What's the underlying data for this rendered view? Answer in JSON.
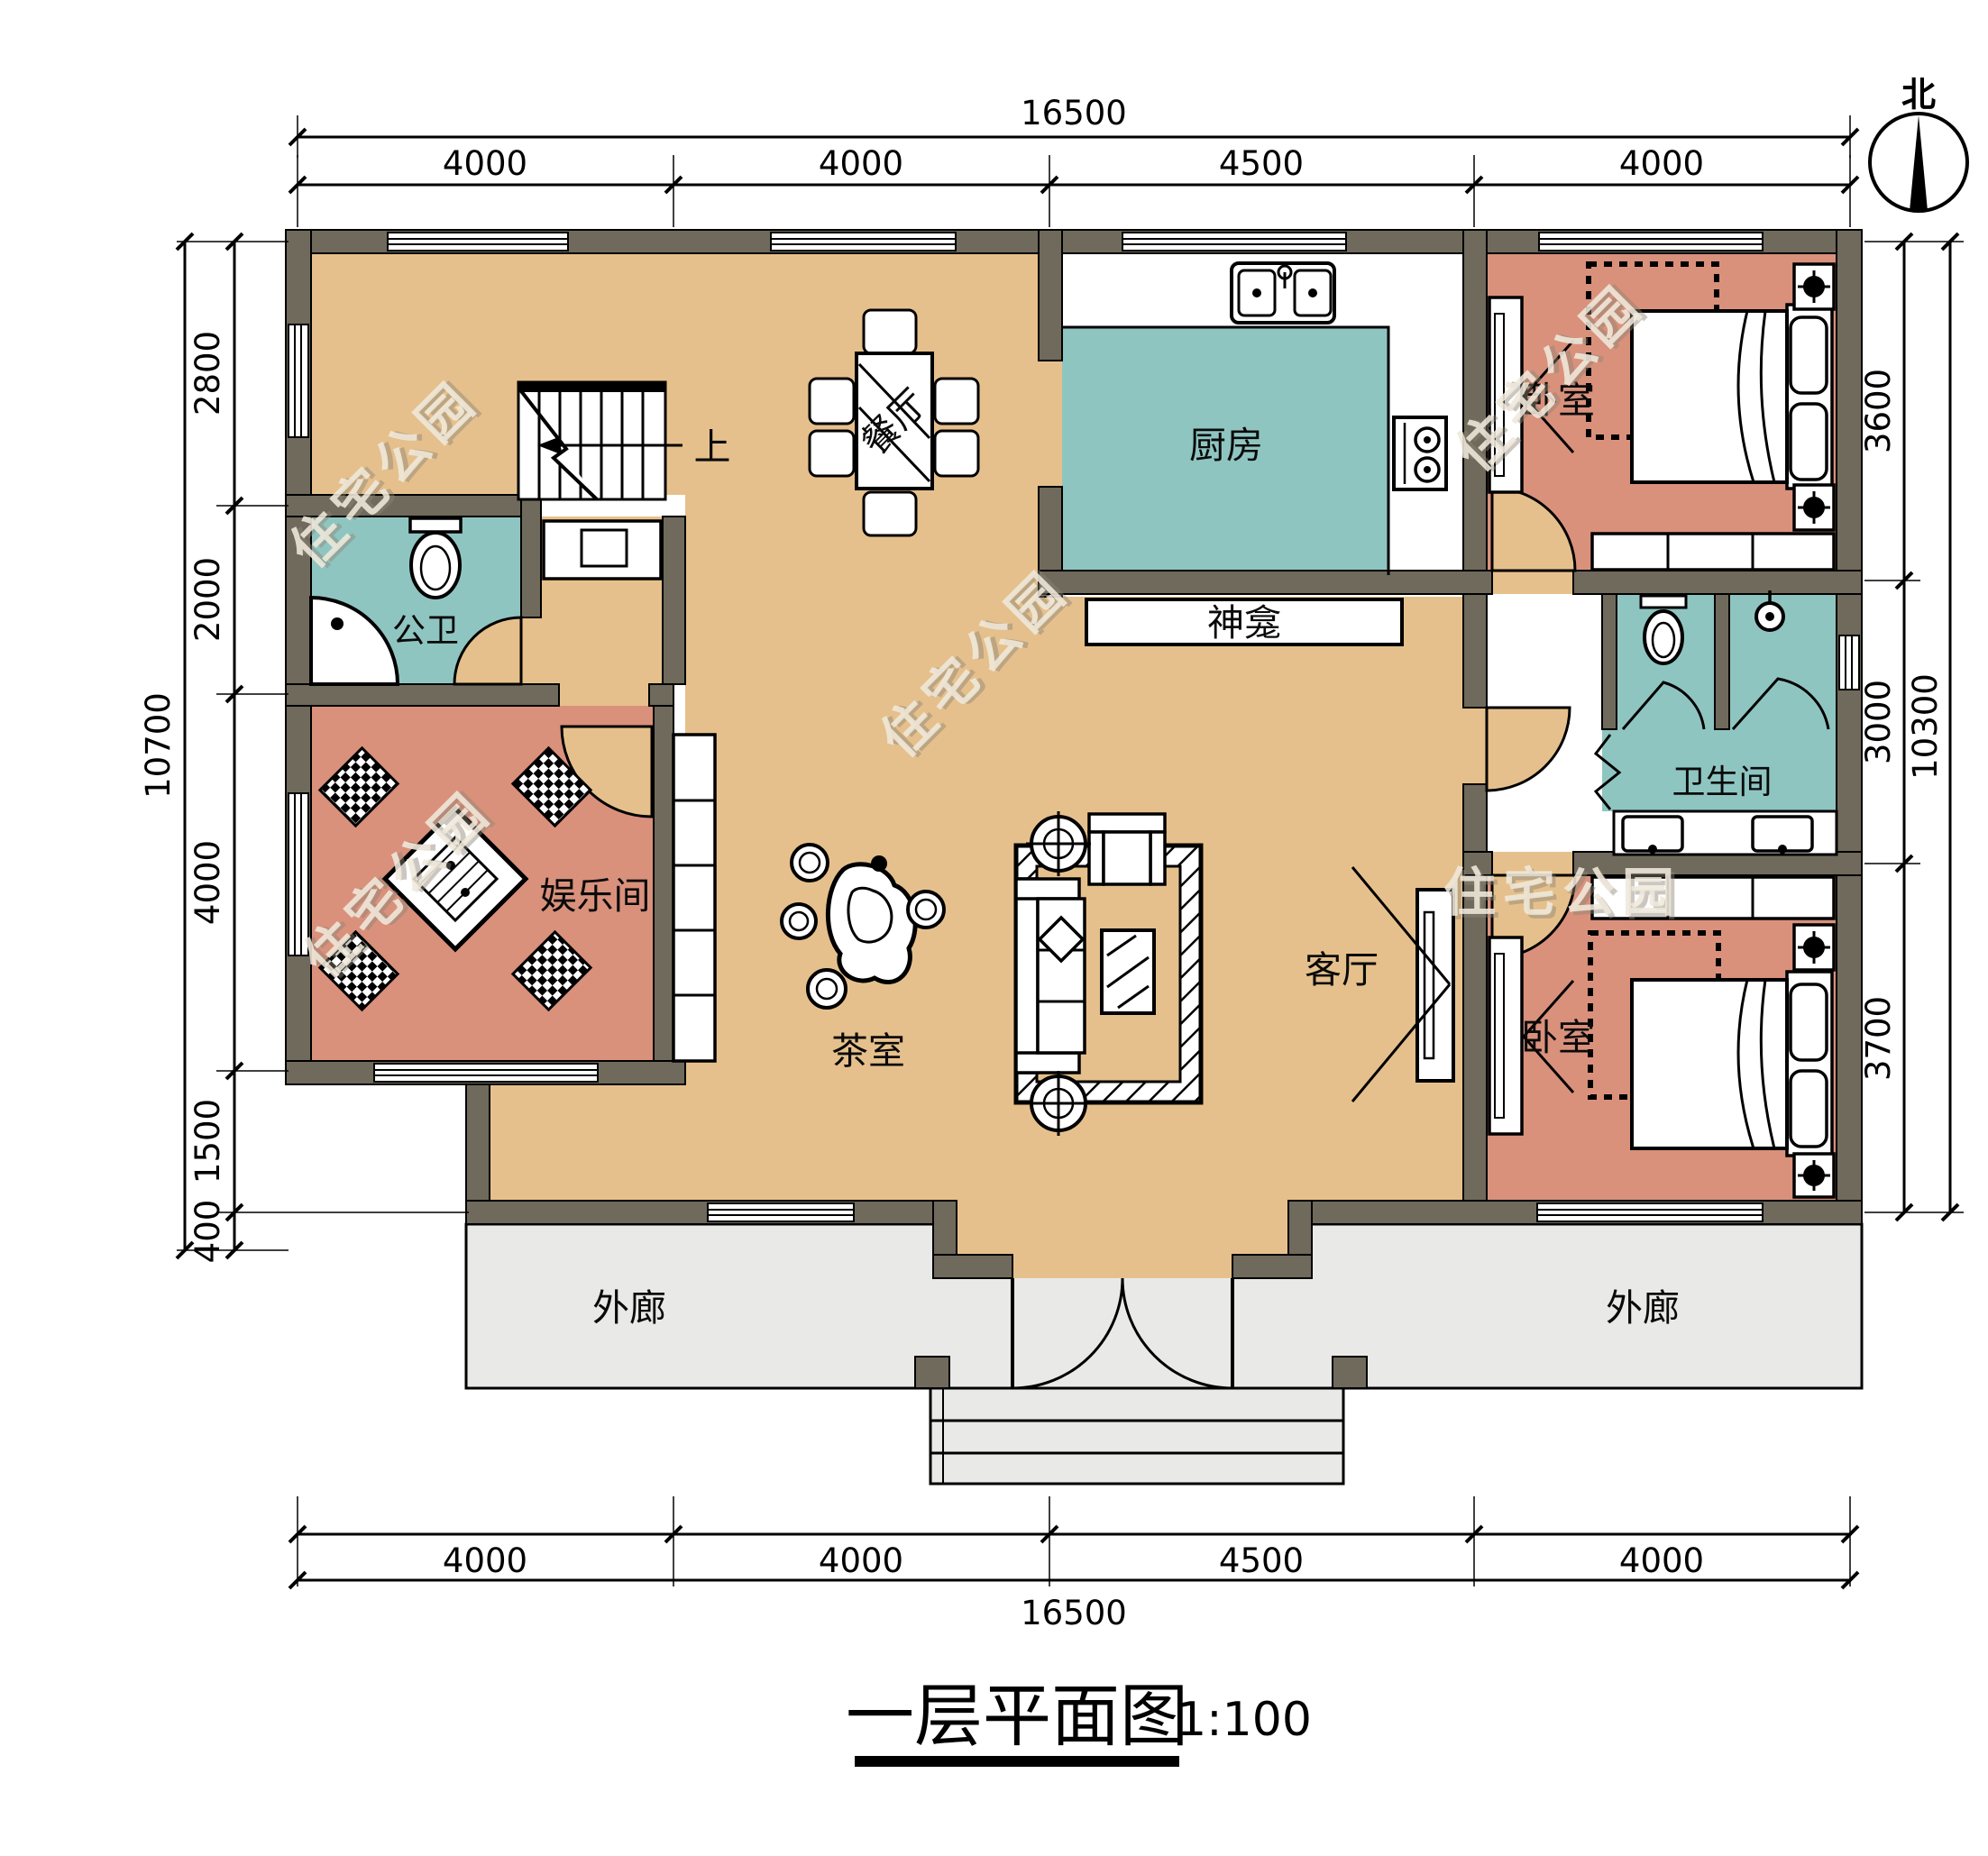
{
  "title": {
    "text": "一层平面图",
    "scale": "1:100"
  },
  "compass": {
    "north_label": "北"
  },
  "watermark": {
    "text": "住宅公园"
  },
  "rooms": {
    "dining": "餐厅",
    "kitchen": "厨房",
    "bedroom_top": "卧室",
    "bath_left": "公卫",
    "entertainment": "娱乐间",
    "tea": "茶室",
    "living": "客厅",
    "shrine": "神龛",
    "bath_right": "卫生间",
    "bedroom_bottom": "卧室",
    "veranda_left": "外廊",
    "veranda_right": "外廊",
    "stairs_up": "上"
  },
  "dimensions": {
    "top": {
      "total": "16500",
      "segments": [
        "4000",
        "4000",
        "4500",
        "4000"
      ]
    },
    "bottom": {
      "total": "16500",
      "segments": [
        "4000",
        "4000",
        "4500",
        "4000"
      ]
    },
    "left": {
      "total": "10700",
      "segments": [
        "2800",
        "2000",
        "4000",
        "1500",
        "400"
      ]
    },
    "right": {
      "total": "10300",
      "segments": [
        "3600",
        "3000",
        "3700"
      ]
    }
  },
  "colors": {
    "wall": "#6F6A5C",
    "floor_hall": "#E6C08C",
    "floor_wet": "#8FC5C1",
    "floor_bedroom": "#D9917C",
    "floor_veranda": "#E9E9E7",
    "watermark": "#F0E9DC"
  }
}
